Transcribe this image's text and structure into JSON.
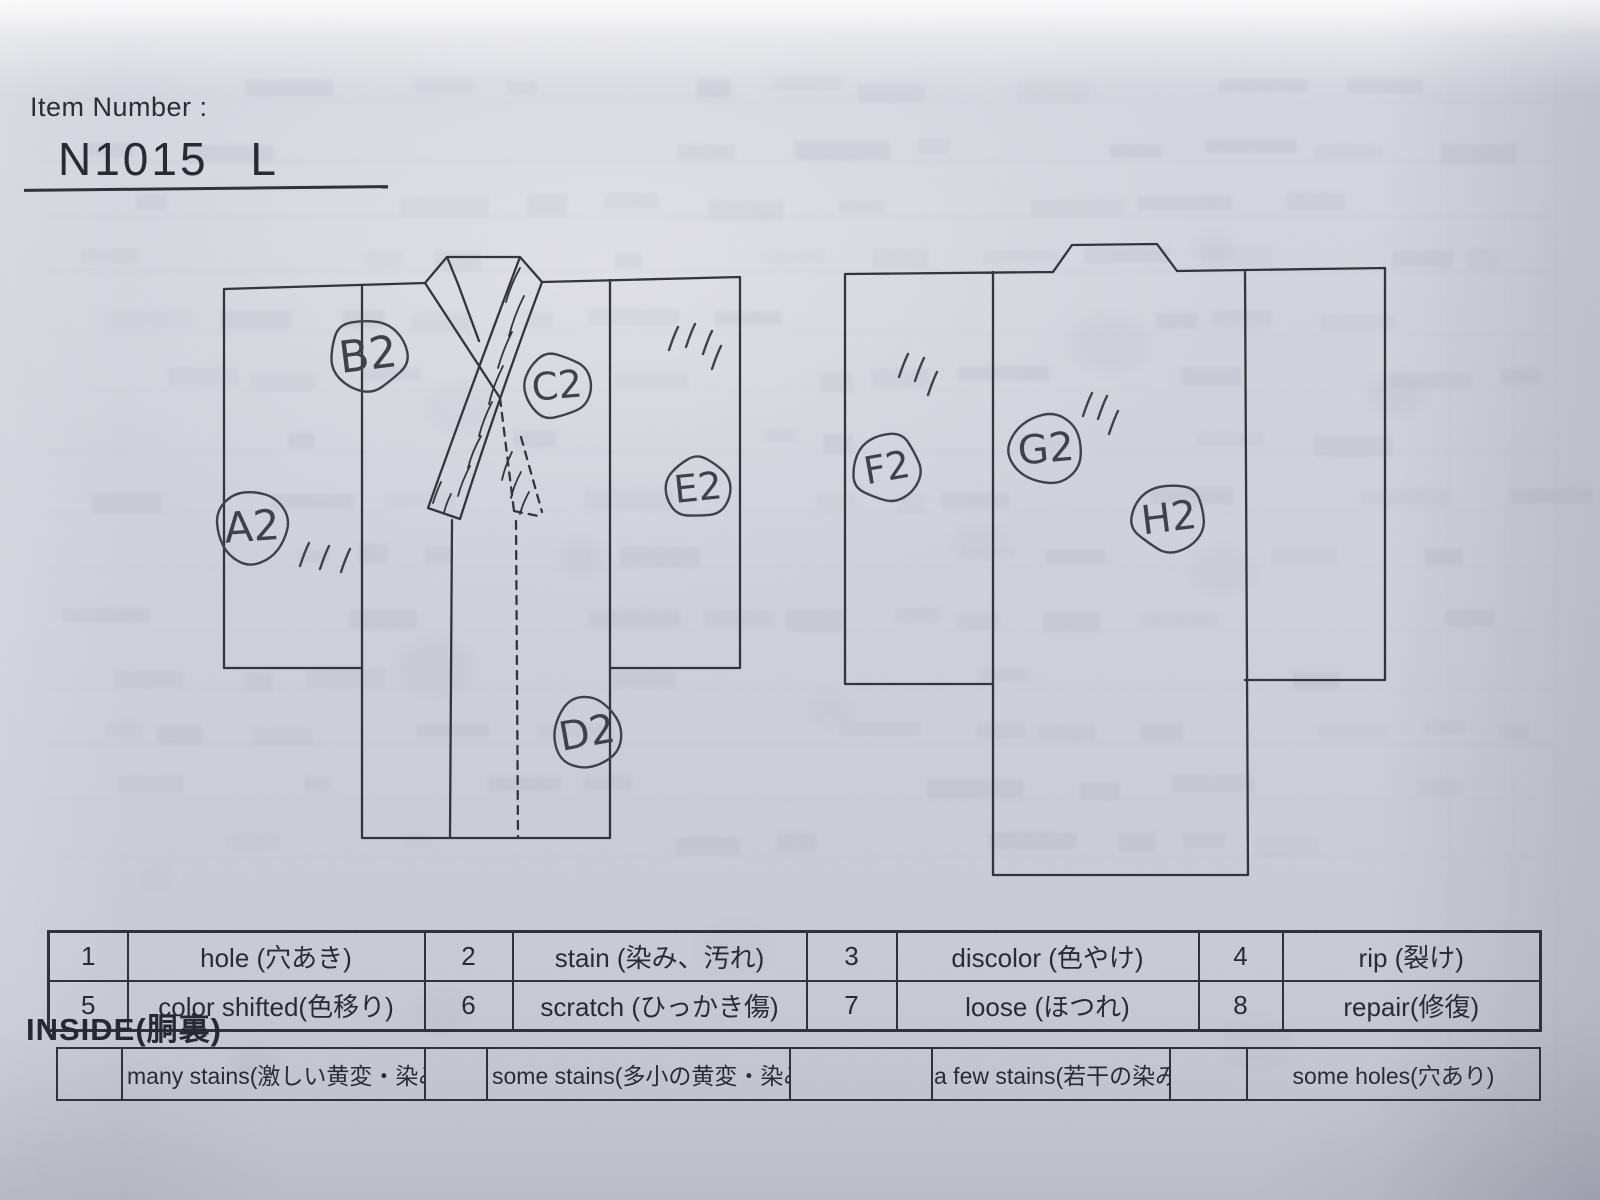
{
  "header": {
    "item_number_label": "Item Number :",
    "item_number_value": "N1015 L"
  },
  "tables": {
    "defects": {
      "cells": [
        {
          "num": "1",
          "label": "hole (穴あき)"
        },
        {
          "num": "2",
          "label": "stain (染み、汚れ)"
        },
        {
          "num": "3",
          "label": "discolor (色やけ)"
        },
        {
          "num": "4",
          "label": "rip (裂け)"
        },
        {
          "num": "5",
          "label": "color shifted(色移り)"
        },
        {
          "num": "6",
          "label": "scratch (ひっかき傷)"
        },
        {
          "num": "7",
          "label": "loose (ほつれ)"
        },
        {
          "num": "8",
          "label": "repair(修復)"
        }
      ]
    },
    "inside": {
      "title": "INSIDE(胴裏)",
      "items": [
        {
          "label": "many stains(激しい黄変・染み)"
        },
        {
          "label": "some stains(多小の黄変・染み)"
        },
        {
          "label": "a few stains(若干の染み)"
        },
        {
          "label": "some holes(穴あり)"
        }
      ]
    }
  },
  "diagrams": {
    "markers": [
      {
        "label": "A2",
        "x": 252,
        "y": 527,
        "rx": 37,
        "ry": 38,
        "fs": 42,
        "rot": -4
      },
      {
        "label": "B2",
        "x": 368,
        "y": 355,
        "rx": 40,
        "ry": 37,
        "fs": 44,
        "rot": -7
      },
      {
        "label": "C2",
        "x": 557,
        "y": 386,
        "rx": 35,
        "ry": 33,
        "fs": 38,
        "rot": -5
      },
      {
        "label": "D2",
        "x": 587,
        "y": 733,
        "rx": 35,
        "ry": 37,
        "fs": 40,
        "rot": -10
      },
      {
        "label": "E2",
        "x": 698,
        "y": 488,
        "rx": 34,
        "ry": 31,
        "fs": 38,
        "rot": -6
      },
      {
        "label": "F2",
        "x": 887,
        "y": 468,
        "rx": 35,
        "ry": 35,
        "fs": 38,
        "rot": -10
      },
      {
        "label": "G2",
        "x": 1046,
        "y": 449,
        "rx": 38,
        "ry": 36,
        "fs": 40,
        "rot": -5
      },
      {
        "label": "H2",
        "x": 1169,
        "y": 518,
        "rx": 38,
        "ry": 35,
        "fs": 40,
        "rot": -7
      }
    ],
    "tick_groups": [
      {
        "strokes": [
          [
            309,
            543
          ],
          [
            329,
            546
          ],
          [
            350,
            549
          ]
        ]
      },
      {
        "strokes": [
          [
            678,
            327
          ],
          [
            695,
            324
          ],
          [
            712,
            331
          ],
          [
            721,
            346
          ]
        ]
      },
      {
        "strokes": [
          [
            908,
            354
          ],
          [
            924,
            358
          ],
          [
            937,
            372
          ]
        ]
      },
      {
        "strokes": [
          [
            1092,
            393
          ],
          [
            1107,
            396
          ],
          [
            1118,
            411
          ]
        ]
      }
    ]
  },
  "colors": {
    "paper": "#d3d4dc",
    "ink": "#2b2b33",
    "pen": "#3b3b44"
  }
}
